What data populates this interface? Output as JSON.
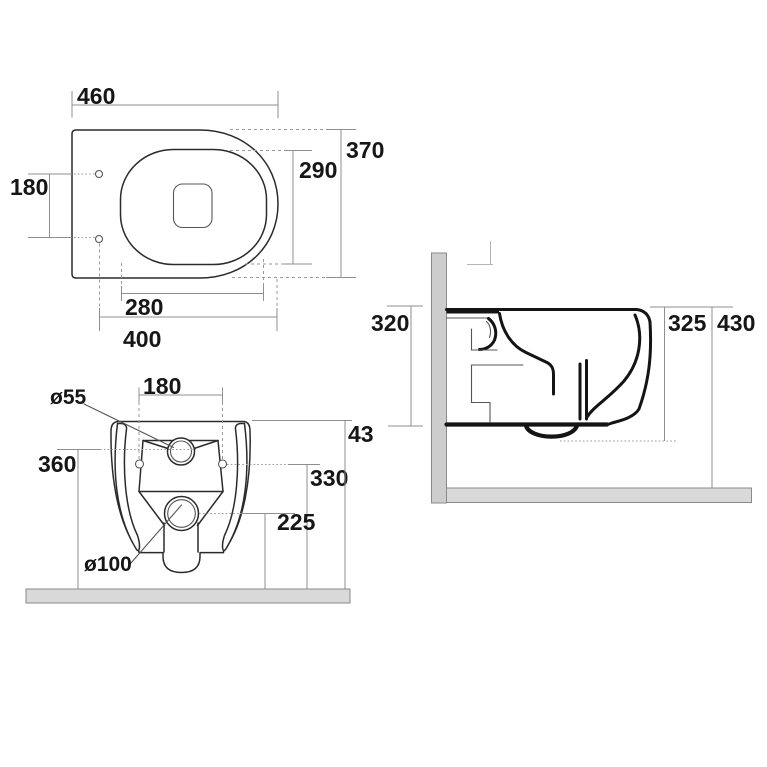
{
  "drawing": {
    "plan_view": {
      "overall_width": "460",
      "overall_depth": "370",
      "bowl_opening_depth": "290",
      "fixing_holes_spacing": "180",
      "bowl_opening_width": "280",
      "holes_to_front": "400"
    },
    "front_view": {
      "flush_inlet_diameter": "ø55",
      "fixing_holes_spacing": "180",
      "flush_inlet_height": "360",
      "fixing_holes_height": "330",
      "outlet_height": "225",
      "outlet_diameter": "ø100",
      "overall_height_truncated": "43"
    },
    "side_view": {
      "depth_at_wall": "320",
      "body_height": "325",
      "rim_height_from_floor": "430"
    }
  },
  "colors": {
    "background": "#ffffff",
    "drawing_line": "#2b2b2b",
    "section_line": "#141414",
    "dimension_line": "#8f8f8f",
    "label_text": "#161616",
    "wall_fill": "#cdcdcd",
    "floor_fill": "#d9d9d9"
  }
}
